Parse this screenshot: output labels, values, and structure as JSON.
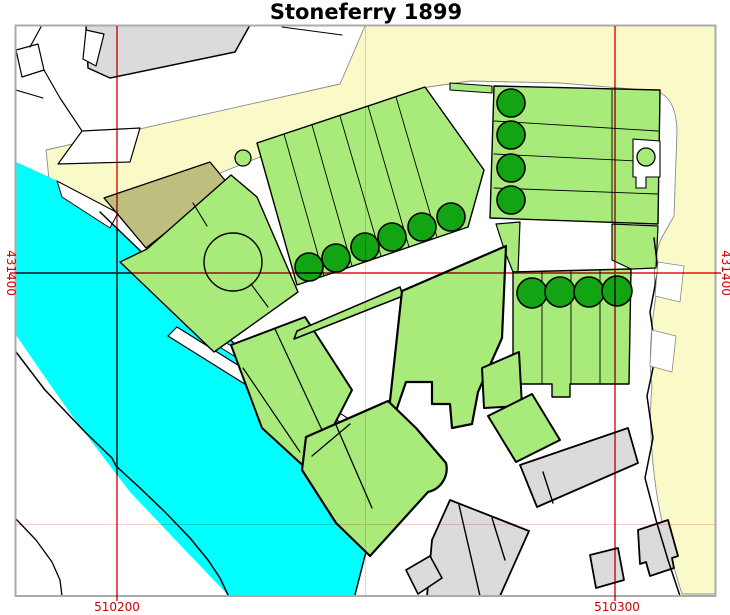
{
  "title": "Stoneferry 1899",
  "axis": {
    "label_color": "#d10000",
    "x_tick_labels": [
      {
        "label": "510200",
        "x": 117,
        "y": 611
      },
      {
        "label": "510300",
        "x": 617,
        "y": 611
      }
    ],
    "y_tick_labels": [
      {
        "label": "431400",
        "x": 7,
        "y": 273,
        "side": "left"
      },
      {
        "label": "431400",
        "x": 722,
        "y": 273,
        "side": "right"
      }
    ],
    "major_gridlines": {
      "color": "#e73535",
      "width": 1.7,
      "vertical_x": [
        117,
        615
      ],
      "horizontal_y": [
        273
      ],
      "v_extent": [
        26,
        601
      ],
      "h_extent": [
        10,
        721
      ]
    },
    "minor_gridlines": {
      "color": "#f8cfc9",
      "width": 1.1,
      "vertical_x": [
        365.5
      ],
      "horizontal_y": [
        524.5
      ],
      "v_extent": [
        26,
        596
      ],
      "h_extent": [
        16,
        716
      ]
    }
  },
  "frame": {
    "x": 15.5,
    "y": 25.5,
    "width": 700,
    "height": 570.5,
    "stroke": "#ababab",
    "stroke_width": 2
  },
  "legend_colors": {
    "water": "#00ffff",
    "parcel_green": "#a9eb7a",
    "tree_green": "#12a412",
    "sand_yellow": "#fafac8",
    "olive": "#bebe7e",
    "building_gray": "#dbdbdb"
  },
  "map": {
    "features": [
      {
        "name": "sand-region",
        "type": "path",
        "fill": "#fafac8",
        "stroke": "#8a8a8a",
        "sw": 0.9,
        "d": "M46,150 L340,84 L365,26 L716,26 L716,594 L682,594 C670,556 659,516 655,481 C651,449 649,416 652,386 C648,356 652,321 656,296 C652,269 656,251 661,239 L674,216 L677,131 Q676,97 656,91 L560,83 L470,81 L428,87 L320,133 L200,181 L104,221 L78,219 L50,189 Z"
      },
      {
        "name": "river",
        "type": "polygon",
        "fill": "#00ffff",
        "points": "16,162 60,182 100,212 155,265 215,325 272,380 330,440 368,495 371,532 355,595 228,595 185,550 130,492 75,420 40,370 16,335"
      },
      {
        "name": "slipway-notch",
        "type": "polygon",
        "fill": "#ffffff",
        "stroke": "#000000",
        "sw": 1,
        "points": "57,181 118,213 110,228 62,197"
      },
      {
        "name": "ne-bank-line",
        "type": "polyline",
        "stroke": "#000000",
        "sw": 1.5,
        "points": "100,212 155,265 215,325 272,380 330,440 368,495 371,532 355,595"
      },
      {
        "name": "sw-foreshore-line",
        "type": "polyline",
        "stroke": "#000000",
        "sw": 1.5,
        "points": "16,352 45,390 85,432 112,458 116,466 140,488 165,512 190,538 208,560 220,578 228,595"
      },
      {
        "name": "corner-shore-line",
        "type": "polyline",
        "stroke": "#000000",
        "sw": 1.3,
        "points": "16,519 36,540 52,562 60,580 62,596"
      },
      {
        "name": "wharf-strip",
        "type": "polygon",
        "fill": "#ffffff",
        "stroke": "#000000",
        "sw": 1.2,
        "points": "168,336 177,327 396,464 387,473"
      },
      {
        "name": "wharf-strip",
        "type": "polygon",
        "fill": "#ffffff",
        "stroke": "#000000",
        "sw": 1,
        "points": "186,326 191,321 404,453 399,459"
      },
      {
        "name": "gray-building-nw",
        "type": "polygon",
        "fill": "#dbdbdb",
        "stroke": "#000000",
        "sw": 1.5,
        "points": "86,25 250,25 235,52 110,78 88,68"
      },
      {
        "name": "nw-building-notch",
        "type": "polygon",
        "fill": "#ffffff",
        "stroke": "#000000",
        "sw": 1.2,
        "points": "86,30 104,34 96,66 83,59"
      },
      {
        "name": "nw-plot-quad",
        "type": "polygon",
        "fill": "#ffffff",
        "stroke": "#000000",
        "sw": 1.2,
        "points": "16,50 38,44 44,70 22,77"
      },
      {
        "name": "nw-boundary-line",
        "type": "polyline",
        "stroke": "#000000",
        "sw": 1.2,
        "points": "42,25 30,47"
      },
      {
        "name": "nw-boundary-line",
        "type": "polyline",
        "stroke": "#000000",
        "sw": 1.2,
        "points": "44,70 60,98 82,131"
      },
      {
        "name": "nw-boundary-line",
        "type": "polyline",
        "stroke": "#000000",
        "sw": 1.1,
        "points": "16,90 43,98"
      },
      {
        "name": "nw-wedge",
        "type": "polygon",
        "fill": "#ffffff",
        "stroke": "#000000",
        "sw": 1.2,
        "points": "82,131 140,128 130,162 58,164"
      },
      {
        "name": "top-boundary-line",
        "type": "polyline",
        "stroke": "#000000",
        "sw": 1.1,
        "points": "282,27 342,35"
      },
      {
        "name": "olive-parcel",
        "type": "polygon",
        "fill": "#bebe7e",
        "stroke": "#000000",
        "sw": 1.3,
        "points": "104,198 210,162 228,184 146,248"
      },
      {
        "name": "circle-parcel",
        "type": "polygon",
        "fill": "#a9eb7a",
        "stroke": "#000000",
        "sw": 1.4,
        "points": "120,262 147,249 231,175 257,197 298,292 214,352"
      },
      {
        "name": "parcel-round-feature",
        "type": "circle",
        "cx": 233,
        "cy": 262,
        "r": 29,
        "fill": "#a9eb7a",
        "stroke": "#000000",
        "sw": 1.4
      },
      {
        "name": "parcel-path",
        "type": "polyline",
        "stroke": "#000000",
        "sw": 1.1,
        "points": "207,226 193,203"
      },
      {
        "name": "parcel-path",
        "type": "polyline",
        "stroke": "#000000",
        "sw": 1.1,
        "points": "251,284 268,307"
      },
      {
        "name": "allotment-strip-block",
        "type": "polygon",
        "fill": "#a9eb7a",
        "stroke": "#000000",
        "sw": 1.4,
        "points": "257,143 425,87 484,170 468,227 297,285"
      },
      {
        "name": "strip-divider",
        "type": "polyline",
        "stroke": "#000000",
        "sw": 0.9,
        "points": "284,134 324,276"
      },
      {
        "name": "strip-divider",
        "type": "polyline",
        "stroke": "#000000",
        "sw": 0.9,
        "points": "312,125 352,266"
      },
      {
        "name": "strip-divider",
        "type": "polyline",
        "stroke": "#000000",
        "sw": 0.9,
        "points": "340,116 381,256"
      },
      {
        "name": "strip-divider",
        "type": "polyline",
        "stroke": "#000000",
        "sw": 0.9,
        "points": "368,106 409,247"
      },
      {
        "name": "strip-divider",
        "type": "polyline",
        "stroke": "#000000",
        "sw": 0.9,
        "points": "396,97 437,237"
      },
      {
        "name": "block-corner-circle",
        "type": "circle",
        "cx": 243,
        "cy": 158,
        "r": 8,
        "fill": "#a9eb7a",
        "stroke": "#000000",
        "sw": 1.3
      },
      {
        "name": "green-sliver",
        "type": "polygon",
        "fill": "#a9eb7a",
        "stroke": "#000000",
        "sw": 1.1,
        "points": "450,83 492,86 492,93 450,90"
      },
      {
        "name": "topright-strip-block",
        "type": "polygon",
        "fill": "#a9eb7a",
        "stroke": "#000000",
        "sw": 1.4,
        "points": "494,86 660,90 658,224 490,218"
      },
      {
        "name": "strip-divider",
        "type": "polyline",
        "stroke": "#000000",
        "sw": 0.9,
        "points": "494,121 658,131"
      },
      {
        "name": "strip-divider",
        "type": "polyline",
        "stroke": "#000000",
        "sw": 0.9,
        "points": "494,154 658,162"
      },
      {
        "name": "strip-divider",
        "type": "polyline",
        "stroke": "#000000",
        "sw": 0.9,
        "points": "494,188 658,194"
      },
      {
        "name": "strip-divider",
        "type": "polyline",
        "stroke": "#000000",
        "sw": 0.9,
        "points": "612,90 612,222"
      },
      {
        "name": "topright-notch",
        "type": "polygon",
        "fill": "#ffffff",
        "stroke": "#000000",
        "sw": 1.1,
        "points": "633,139 660,141 660,177 646,177 646,188 636,188 636,177 633,177"
      },
      {
        "name": "notch-circle",
        "type": "circle",
        "cx": 646,
        "cy": 157,
        "r": 9,
        "fill": "#a9eb7a",
        "stroke": "#000000",
        "sw": 1.3
      },
      {
        "name": "midright-extension",
        "type": "polygon",
        "fill": "#a9eb7a",
        "stroke": "#000000",
        "sw": 1.2,
        "points": "496,224 520,222 518,272 513,272 505,252"
      },
      {
        "name": "midright-extension",
        "type": "polygon",
        "fill": "#a9eb7a",
        "stroke": "#000000",
        "sw": 1.2,
        "points": "612,224 658,226 656,268 631,269 612,260"
      },
      {
        "name": "midright-strip-block",
        "type": "polygon",
        "fill": "#a9eb7a",
        "stroke": "#000000",
        "sw": 1.4,
        "points": "513,272 631,269 629,384 570,384 570,397 552,397 552,384 513,384"
      },
      {
        "name": "strip-divider",
        "type": "polyline",
        "stroke": "#000000",
        "sw": 0.9,
        "points": "542,272 542,384"
      },
      {
        "name": "strip-divider",
        "type": "polyline",
        "stroke": "#000000",
        "sw": 0.9,
        "points": "571,271 571,384"
      },
      {
        "name": "strip-divider",
        "type": "polyline",
        "stroke": "#000000",
        "sw": 0.9,
        "points": "600,270 600,384"
      },
      {
        "name": "left-parcel",
        "type": "polygon",
        "fill": "#a9eb7a",
        "stroke": "#000000",
        "sw": 2,
        "points": "231,345 305,317 352,390 310,472 262,428"
      },
      {
        "name": "parcel-divider",
        "type": "polyline",
        "stroke": "#000000",
        "sw": 1.2,
        "points": "275,329 322,430"
      },
      {
        "name": "parcel-divider",
        "type": "polyline",
        "stroke": "#000000",
        "sw": 1.2,
        "points": "243,368 300,452"
      },
      {
        "name": "narrow-strip-parcel",
        "type": "polygon",
        "fill": "#a9eb7a",
        "stroke": "#000000",
        "sw": 1.6,
        "points": "294,339 297,331 400,287 403,296"
      },
      {
        "name": "central-works-parcel",
        "type": "polygon",
        "fill": "#a9eb7a",
        "stroke": "#000000",
        "sw": 2.2,
        "points": "402,291 506,246 502,338 478,392 472,424 452,428 450,404 432,404 432,382 406,382 395,414 389,410"
      },
      {
        "name": "bottom-parcel-cluster",
        "type": "path",
        "fill": "#a9eb7a",
        "stroke": "#000000",
        "sw": 2.2,
        "d": "M306,437 L388,401 L416,428 L446,463 A24,24 0 0 1 428,492 L370,556 L336,523 L302,470 Z"
      },
      {
        "name": "parcel-divider",
        "type": "polyline",
        "stroke": "#000000",
        "sw": 1.3,
        "points": "336,425 372,508"
      },
      {
        "name": "parcel-divider",
        "type": "polyline",
        "stroke": "#000000",
        "sw": 1.3,
        "points": "312,456 350,424"
      },
      {
        "name": "se-parcel",
        "type": "polygon",
        "fill": "#a9eb7a",
        "stroke": "#000000",
        "sw": 2,
        "points": "482,368 519,352 522,406 484,408"
      },
      {
        "name": "se-parcel",
        "type": "polygon",
        "fill": "#a9eb7a",
        "stroke": "#000000",
        "sw": 2,
        "points": "488,416 532,394 560,440 516,462"
      },
      {
        "name": "long-building",
        "type": "polygon",
        "fill": "#dbdbdb",
        "stroke": "#000000",
        "sw": 1.8,
        "points": "520,465 628,428 638,463 537,507"
      },
      {
        "name": "building-divider",
        "type": "polyline",
        "stroke": "#000000",
        "sw": 1.4,
        "points": "543,472 553,503"
      },
      {
        "name": "building-cluster",
        "type": "polygon",
        "fill": "#dbdbdb",
        "stroke": "#000000",
        "sw": 1.8,
        "points": "450,500 529,531 500,596 427,596 432,540"
      },
      {
        "name": "building-divider",
        "type": "polyline",
        "stroke": "#000000",
        "sw": 1.4,
        "points": "459,505 480,596"
      },
      {
        "name": "building-divider",
        "type": "polyline",
        "stroke": "#000000",
        "sw": 1.4,
        "points": "492,518 505,560"
      },
      {
        "name": "small-building",
        "type": "polygon",
        "fill": "#dbdbdb",
        "stroke": "#000000",
        "sw": 1.6,
        "points": "406,570 430,556 442,578 418,594"
      },
      {
        "name": "stepped-building",
        "type": "polygon",
        "fill": "#dbdbdb",
        "stroke": "#000000",
        "sw": 1.8,
        "points": "638,530 668,520 678,556 672,558 674,568 650,576 646,562 640,564"
      },
      {
        "name": "small-building",
        "type": "polygon",
        "fill": "#dbdbdb",
        "stroke": "#000000",
        "sw": 1.8,
        "points": "590,555 618,548 624,580 596,588"
      },
      {
        "name": "right-road-line",
        "type": "polyline",
        "stroke": "#000000",
        "sw": 1.5,
        "points": "654,238 658,270 650,312 656,354 647,396 653,438 645,478 656,520 668,560 680,596"
      },
      {
        "name": "road-pocket",
        "type": "polygon",
        "fill": "#ffffff",
        "stroke": "#888888",
        "sw": 0.8,
        "points": "658,262 684,266 680,302 655,296"
      },
      {
        "name": "road-pocket",
        "type": "polygon",
        "fill": "#ffffff",
        "stroke": "#888888",
        "sw": 0.8,
        "points": "652,330 676,336 672,372 650,366"
      }
    ],
    "trees": [
      [
        309,
        267,
        14
      ],
      [
        336,
        258,
        14
      ],
      [
        365,
        247,
        14
      ],
      [
        392,
        237,
        14
      ],
      [
        422,
        227,
        14
      ],
      [
        451,
        217,
        14
      ],
      [
        511,
        103,
        14
      ],
      [
        511,
        135,
        14
      ],
      [
        511,
        168,
        14
      ],
      [
        511,
        200,
        14
      ],
      [
        532,
        293,
        15
      ],
      [
        560,
        292,
        15
      ],
      [
        589,
        292,
        15
      ],
      [
        617,
        291,
        15
      ]
    ]
  }
}
